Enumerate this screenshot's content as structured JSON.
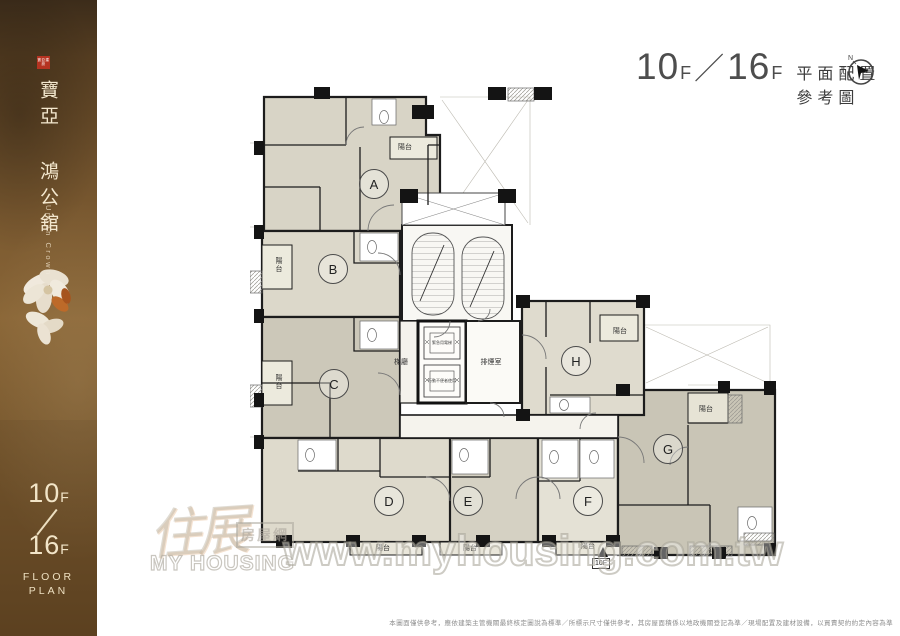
{
  "sidebar": {
    "seal_text": "寶亞建設",
    "title_zh": "寶亞 鴻公舘",
    "subtitle_en": "Urban Crown",
    "floor_top": "10",
    "floor_bottom": "16",
    "floor_suffix": "F",
    "floor_word1": "FLOOR",
    "floor_word2": "PLAN"
  },
  "header": {
    "floor_left": "10",
    "floor_right": "16",
    "floor_suffix": "F",
    "separator": "／",
    "title": "平面配置參考圖",
    "compass_n": "N"
  },
  "plan": {
    "units": [
      {
        "label": "A"
      },
      {
        "label": "B"
      },
      {
        "label": "C"
      },
      {
        "label": "D"
      },
      {
        "label": "E"
      },
      {
        "label": "F"
      },
      {
        "label": "G"
      },
      {
        "label": "H"
      }
    ],
    "balcony_label": "陽台",
    "core": {
      "lobby": "梯廳",
      "smoke_room": "排煙室",
      "elevator_1": "緊急用電梯",
      "elevator_2": "行動不便者使用",
      "marker_floor": "10F"
    }
  },
  "watermark": {
    "logo_zh": "住展",
    "logo_box": "房屋網",
    "logo_en": "MY HOUSING",
    "url": "www.myhousing.com.tw"
  },
  "footer": {
    "disclaimer": "本圖面僅供參考，應依建築主管機關最終核定圖說為標準／所標示尺寸僅供參考，其房屋面積係以地政機關登記為準／現場配置及建材設備，以買賣契約約定內容為準"
  },
  "colors": {
    "sidebar_brown": "#7a5930",
    "seal_red": "#b53321",
    "cream_text": "#f2e5c8",
    "wall_black": "#1c1c1c",
    "room_beige": "#d8d4c6",
    "watermark_gray": "#b8b5ac"
  }
}
